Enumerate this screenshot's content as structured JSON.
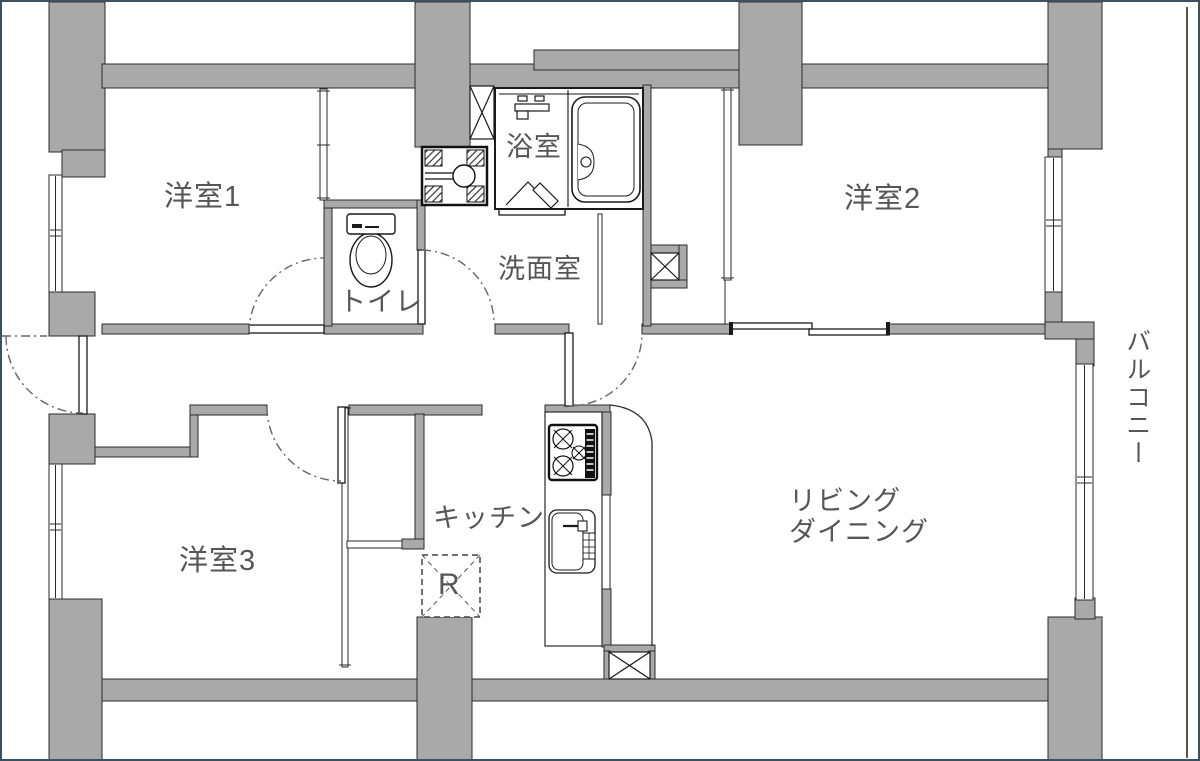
{
  "labels": {
    "room1": "洋室1",
    "room2": "洋室2",
    "room3": "洋室3",
    "bathroom": "浴室",
    "washroom": "洗面室",
    "toilet": "トイレ",
    "kitchen": "キッチン",
    "living_line1": "リビング",
    "living_line2": "ダイニング",
    "balcony": "バルコニー",
    "refrigerator": "R"
  },
  "colors": {
    "wall": "#a9a9a9",
    "wall_outline": "#2a2a2a",
    "fixture_line": "#1a1a1a",
    "label_text": "#565656",
    "door_arc": "#666666",
    "frame_border": "#3d505e",
    "background": "#ffffff"
  }
}
